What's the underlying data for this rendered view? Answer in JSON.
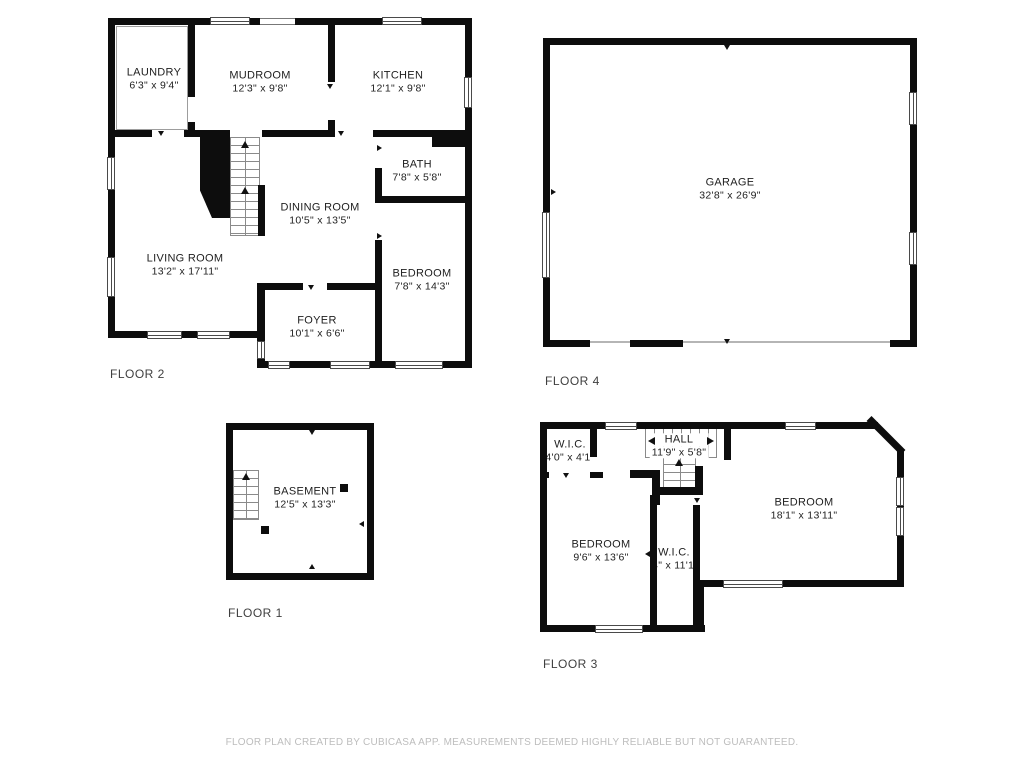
{
  "floors": {
    "floor2": {
      "label": "FLOOR 2",
      "rooms": {
        "laundry": {
          "name": "LAUNDRY",
          "dims": "6'3\" x 9'4\""
        },
        "mudroom": {
          "name": "MUDROOM",
          "dims": "12'3\" x 9'8\""
        },
        "kitchen": {
          "name": "KITCHEN",
          "dims": "12'1\" x 9'8\""
        },
        "bath": {
          "name": "BATH",
          "dims": "7'8\" x 5'8\""
        },
        "dining": {
          "name": "DINING ROOM",
          "dims": "10'5\" x 13'5\""
        },
        "living": {
          "name": "LIVING ROOM",
          "dims": "13'2\" x 17'11\""
        },
        "bedroom": {
          "name": "BEDROOM",
          "dims": "7'8\" x 14'3\""
        },
        "foyer": {
          "name": "FOYER",
          "dims": "10'1\" x 6'6\""
        }
      }
    },
    "floor4": {
      "label": "FLOOR 4",
      "rooms": {
        "garage": {
          "name": "GARAGE",
          "dims": "32'8\" x 26'9\""
        }
      }
    },
    "floor1": {
      "label": "FLOOR 1",
      "rooms": {
        "basement": {
          "name": "BASEMENT",
          "dims": "12'5\" x 13'3\""
        }
      }
    },
    "floor3": {
      "label": "FLOOR 3",
      "rooms": {
        "wic1": {
          "name": "W.I.C.",
          "dims": "4'0\" x 4'1\""
        },
        "hall": {
          "name": "HALL",
          "dims": "11'9\" x 5'8\""
        },
        "bedroom1": {
          "name": "BEDROOM",
          "dims": "18'1\" x 13'11\""
        },
        "bedroom2": {
          "name": "BEDROOM",
          "dims": "9'6\" x 13'6\""
        },
        "wic2": {
          "name": "W.I.C.",
          "dims": "'4\" x 11'1\""
        }
      }
    }
  },
  "footer": {
    "disclaimer": "FLOOR PLAN CREATED BY CUBICASA APP. MEASUREMENTS DEEMED HIGHLY RELIABLE BUT NOT GUARANTEED."
  }
}
